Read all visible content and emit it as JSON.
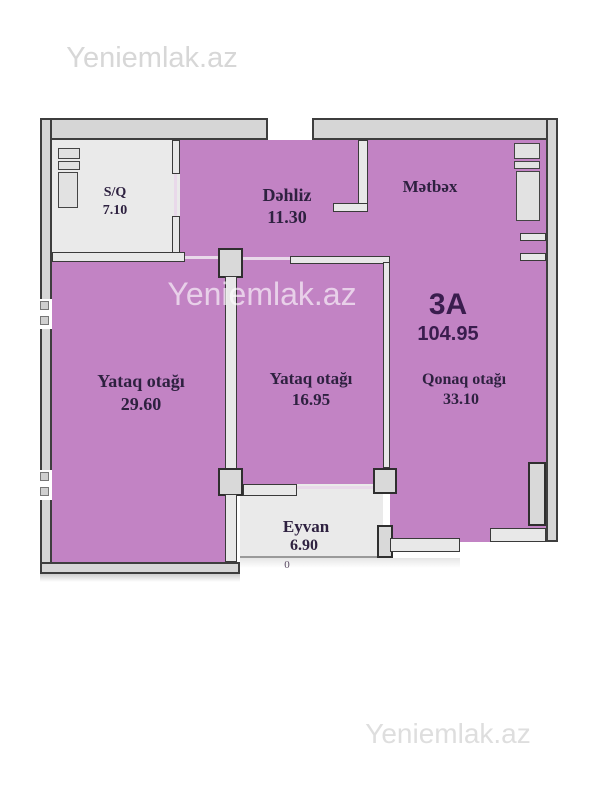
{
  "watermarks": {
    "top": "Yeniemlak.az",
    "middle": "Yeniemlak.az",
    "bottom": "Yeniemlak.az"
  },
  "plan": {
    "unit_label": "3A",
    "unit_area": "104.95",
    "stray_mark": "0",
    "rooms": {
      "sq": {
        "name": "S/Q",
        "area": "7.10"
      },
      "dehliz": {
        "name": "Dəhliz",
        "area": "11.30"
      },
      "metbex": {
        "name": "Mətbəx"
      },
      "yataq1": {
        "name": "Yataq otağı",
        "area": "29.60"
      },
      "yataq2": {
        "name": "Yataq otağı",
        "area": "16.95"
      },
      "qonaq": {
        "name": "Qonaq otağı",
        "area": "33.10"
      },
      "eyvan": {
        "name": "Eyvan",
        "area": "6.90"
      }
    },
    "colors": {
      "room_pink": "#c283c4",
      "wall_fill": "#d6d6d6",
      "wall_line": "#3e3e3e",
      "light_floor": "#eaeaea",
      "label_text": "#2e2140",
      "watermark_gray": "#dbdbdb"
    }
  }
}
